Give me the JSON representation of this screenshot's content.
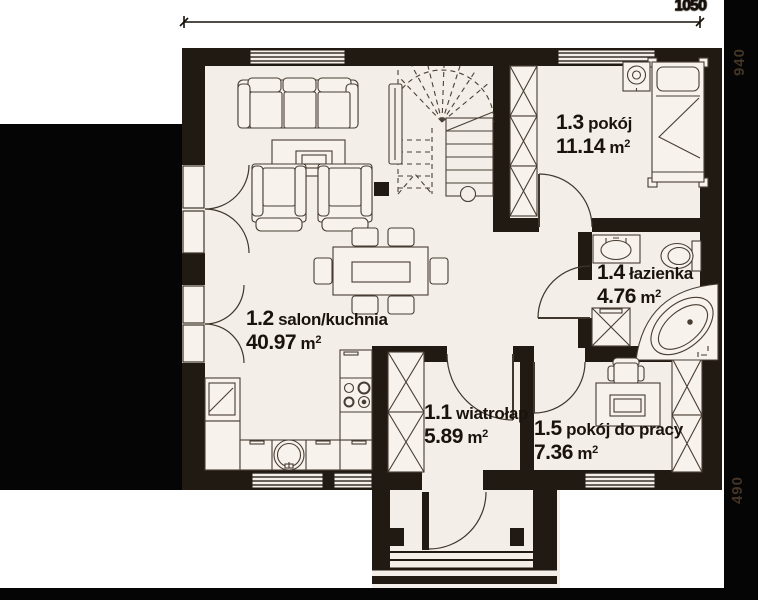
{
  "plan_title": "parter floor plan",
  "rooms": [
    {
      "number": "1.1",
      "name": "wiatrołap",
      "area": "5.89",
      "unit": "m",
      "sup": "2",
      "furniture": [
        "wardrobe"
      ]
    },
    {
      "number": "1.2",
      "name": "salon/kuchnia",
      "area": "40.97",
      "unit": "m",
      "sup": "2",
      "furniture": [
        "sofa",
        "coffee-table",
        "armchair",
        "armchair",
        "dining-table",
        "chairs",
        "fridge",
        "kitchen-sink",
        "stove",
        "counter"
      ]
    },
    {
      "number": "1.3",
      "name": "pokój",
      "area": "11.14",
      "unit": "m",
      "sup": "2",
      "furniture": [
        "wardrobe",
        "bed",
        "nightstand-lamp"
      ]
    },
    {
      "number": "1.4",
      "name": "łazienka",
      "area": "4.76",
      "unit": "m",
      "sup": "2",
      "furniture": [
        "washbasin",
        "toilet",
        "washing-machine",
        "corner-bathtub"
      ]
    },
    {
      "number": "1.5",
      "name": "pokój do pracy",
      "area": "7.36",
      "unit": "m",
      "sup": "2",
      "furniture": [
        "desk",
        "office-chair",
        "wardrobe"
      ]
    }
  ],
  "dimensions": {
    "top": "1050",
    "right_upper": "940",
    "right_lower": "490"
  },
  "colors": {
    "floor": "#f3eee7",
    "wall": "#211a12",
    "mask": "#050505",
    "line": "#46three",
    "furniture_line": "#473d33",
    "text": "#1a130c"
  },
  "elements": [
    "stairs",
    "entrance-door",
    "terrace-double-doors",
    "windows",
    "porch-steps"
  ]
}
